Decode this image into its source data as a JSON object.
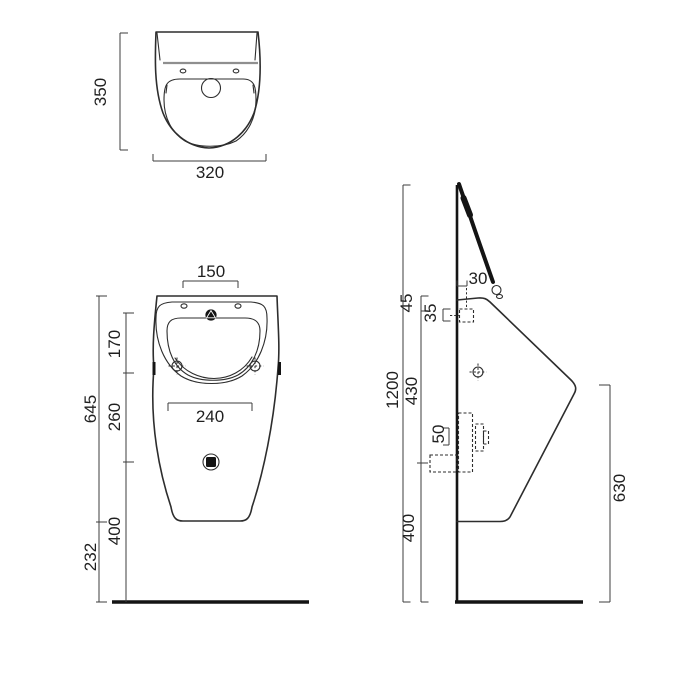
{
  "drawing": {
    "type": "sanitaryware technical dimension drawing",
    "colors": {
      "line": "#2d2d2d",
      "dimension_line": "#3c3c3c",
      "text": "#1f1f1f",
      "gray_detail": "#8f8f8f",
      "solid_black": "#141414",
      "background": "#ffffff"
    },
    "views": {
      "top_view": {
        "height": "350",
        "width": "320"
      },
      "front_view": {
        "inlet_centres": "150",
        "top_to_fixings": "170",
        "overall_height": "645",
        "fixings_to_outlet": "260",
        "fixing_centres": "240",
        "outlet_to_floor": "400",
        "height_below": "232"
      },
      "side_view": {
        "wall_offset": "30",
        "top_to_fixing": "45",
        "fixing_offset": "35",
        "inlet_height": "1200",
        "fixing_to_outlet": "430",
        "outlet_centres": "50",
        "outlet_height": "400",
        "front_edge_height": "630"
      }
    }
  }
}
